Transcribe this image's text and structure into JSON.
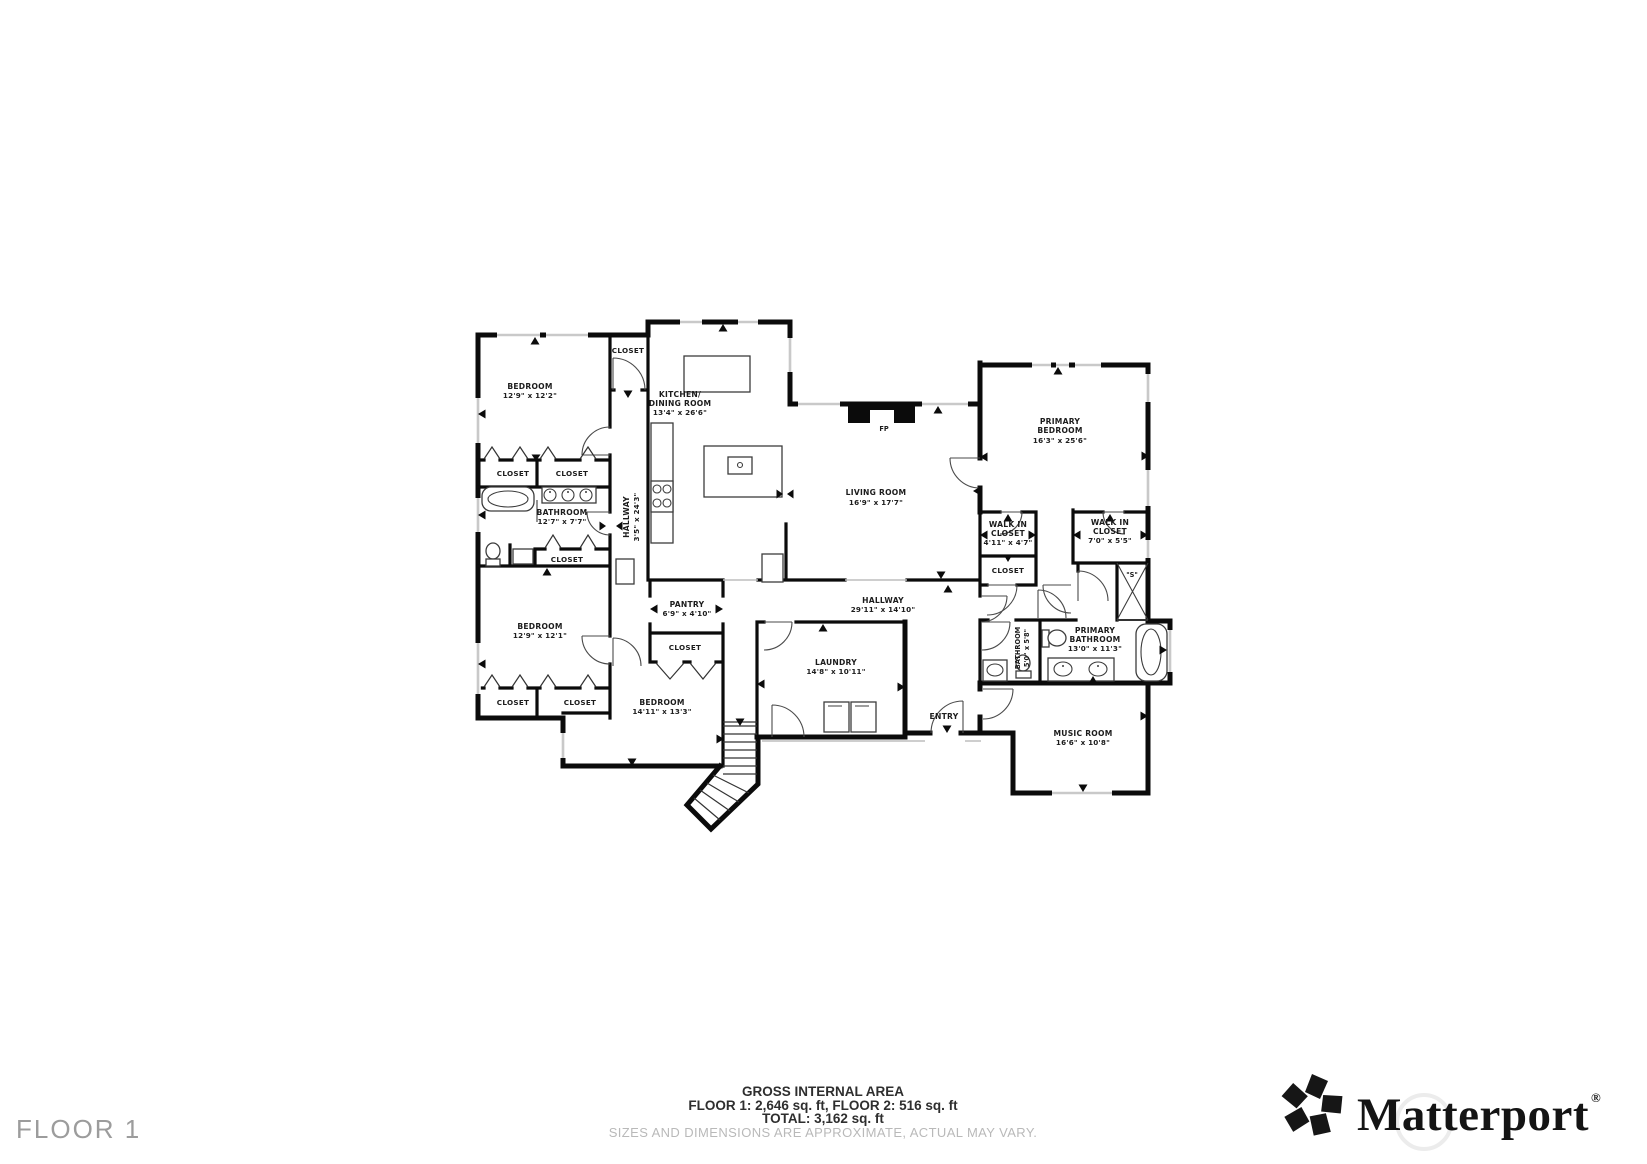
{
  "floor_selector": {
    "label": "FLOOR 1"
  },
  "footer": {
    "title": "GROSS INTERNAL AREA",
    "areas": "FLOOR 1: 2,646 sq. ft, FLOOR 2: 516 sq. ft",
    "total": "TOTAL: 3,162 sq. ft",
    "disclaimer": "SIZES AND DIMENSIONS ARE APPROXIMATE, ACTUAL MAY VARY."
  },
  "brand": {
    "name": "Matterport",
    "registered": "®"
  },
  "colors": {
    "wall": "#0b0b0b",
    "window": "#c9c9c9",
    "label_text": "#1c1c1c",
    "muted_text": "#9c9c9c",
    "disclaimer_text": "#b9b9b9"
  },
  "rooms": {
    "bedroom1": {
      "name": "BEDROOM",
      "dims": "12'9\" x 12'2\""
    },
    "bedroom2": {
      "name": "BEDROOM",
      "dims": "12'9\" x 12'1\""
    },
    "bedroom3": {
      "name": "BEDROOM",
      "dims": "14'11\" x 13'3\""
    },
    "bathroom": {
      "name": "BATHROOM",
      "dims": "12'7\" x 7'7\""
    },
    "kitchen": {
      "name1": "KITCHEN/",
      "name2": "DINING ROOM",
      "dims": "13'4\" x 26'6\""
    },
    "hallway_small": {
      "name": "HALLWAY",
      "dims": "3'5\" x 24'3\""
    },
    "pantry": {
      "name": "PANTRY",
      "dims": "6'9\" x 4'10\""
    },
    "living": {
      "name": "LIVING ROOM",
      "dims": "16'9\" x 17'7\""
    },
    "fireplace": {
      "label": "FP"
    },
    "primary_bedroom": {
      "name1": "PRIMARY",
      "name2": "BEDROOM",
      "dims": "16'3\" x 25'6\""
    },
    "walk_in_closet_1": {
      "name1": "WALK IN",
      "name2": "CLOSET",
      "dims": "4'11\" x 4'7\""
    },
    "walk_in_closet_2": {
      "name1": "WALK IN",
      "name2": "CLOSET",
      "dims": "7'0\" x 5'5\""
    },
    "hallway_main": {
      "name": "HALLWAY",
      "dims": "29'11\" x 14'10\""
    },
    "laundry": {
      "name": "LAUNDRY",
      "dims": "14'8\" x 10'11\""
    },
    "entry": {
      "label": "ENTRY"
    },
    "bathroom_small": {
      "name": "BATHROOM",
      "dims": "5'0\" x 5'8\""
    },
    "primary_bathroom": {
      "name1": "PRIMARY",
      "name2": "BATHROOM",
      "dims": "13'0\" x 11'3\""
    },
    "music": {
      "name": "MUSIC ROOM",
      "dims": "16'6\" x 10'8\""
    },
    "shower": {
      "label": "\"S\""
    },
    "closet_label": "CLOSET"
  }
}
